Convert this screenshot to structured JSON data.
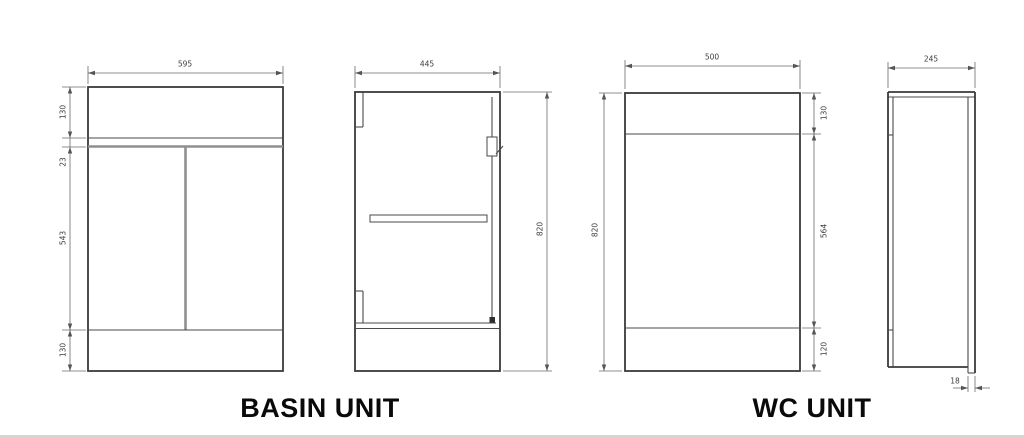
{
  "basin_unit": {
    "title": "BASIN UNIT",
    "front_view": {
      "width": "595",
      "heights": [
        "130",
        "23",
        "543",
        "130"
      ]
    },
    "side_view": {
      "depth": "445",
      "height": "820"
    }
  },
  "wc_unit": {
    "title": "WC UNIT",
    "front_view": {
      "width": "500",
      "height": "820",
      "heights": [
        "130",
        "564",
        "120"
      ]
    },
    "side_view": {
      "depth": "245",
      "panel_thickness": "18"
    }
  },
  "colors": {
    "line": "#3a3a3a",
    "dimension": "#6a6a6a",
    "background": "#ffffff"
  }
}
